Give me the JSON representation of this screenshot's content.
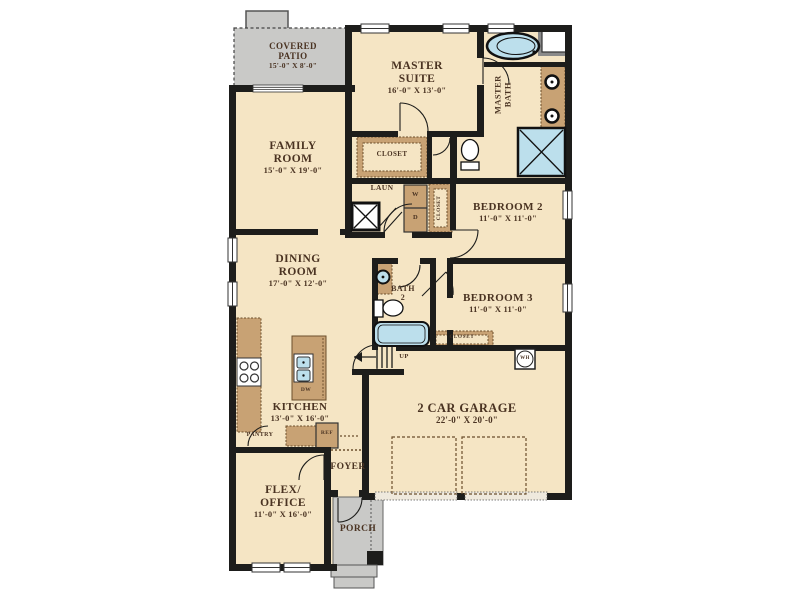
{
  "floorplan": {
    "rooms": {
      "covered_patio": {
        "line1": "COVERED",
        "line2": "PATIO",
        "dims": "15'-0\" X 8'-0\""
      },
      "master_suite": {
        "line1": "MASTER",
        "line2": "SUITE",
        "dims": "16'-0\" X 13'-0\""
      },
      "master_bath": {
        "line1": "MASTER",
        "line2": "BATH"
      },
      "family_room": {
        "line1": "FAMILY",
        "line2": "ROOM",
        "dims": "15'-0\" X 19'-0\""
      },
      "master_closet": {
        "label": "CLOSET"
      },
      "laundry": {
        "label": "LAUN",
        "washer": "W",
        "dryer": "D"
      },
      "hall_closet": {
        "label": "CLOSET"
      },
      "bedroom_2": {
        "name": "BEDROOM 2",
        "dims": "11'-0\" X 11'-0\""
      },
      "dining_room": {
        "line1": "DINING",
        "line2": "ROOM",
        "dims": "17'-0\" X 12'-0\""
      },
      "bath_2": {
        "line1": "BATH",
        "line2": "2"
      },
      "bedroom_3": {
        "name": "BEDROOM 3",
        "dims": "11'-0\" X 11'-0\""
      },
      "bedroom_3_closet": {
        "label": "CLOSET"
      },
      "garage": {
        "name": "2 CAR GARAGE",
        "dims": "22'-0\" X 20'-0\""
      },
      "kitchen": {
        "name": "KITCHEN",
        "dims": "13'-0\" X 16'-0\""
      },
      "pantry": {
        "label": "PANTRY"
      },
      "foyer": {
        "label": "FOYER"
      },
      "flex_office": {
        "line1": "FLEX/",
        "line2": "OFFICE",
        "dims": "11'-0\" X 16'-0\""
      },
      "porch": {
        "label": "PORCH"
      }
    },
    "annotations": {
      "up": "UP",
      "water_heater": "WH",
      "dishwasher": "DW",
      "refrigerator": "REF"
    },
    "colors": {
      "floor": "#f5e5c4",
      "wall": "#1d1d1b",
      "cabinet": "#c8a274",
      "fixture_blue": "#bcdfec",
      "patio_gray": "#c9c9c7",
      "label_text": "#4a3322"
    }
  }
}
